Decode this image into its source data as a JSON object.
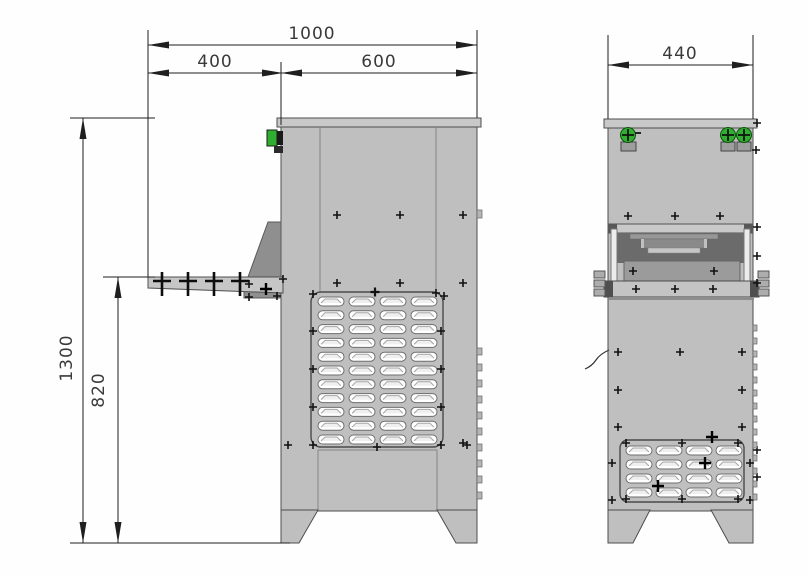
{
  "drawing": {
    "title": "cabinet-two-view-dimension-drawing",
    "unit": "mm",
    "views": [
      "side-elevation",
      "front-elevation"
    ]
  },
  "dims": {
    "total_depth": {
      "value": "1000"
    },
    "shelf_overhang": {
      "value": "400"
    },
    "body_depth": {
      "value": "600"
    },
    "body_width": {
      "value": "440"
    },
    "total_height": {
      "value": "1300"
    },
    "shelf_height": {
      "value": "820"
    }
  },
  "views": {
    "side": {
      "louver_grid": {
        "cols": 4,
        "rows": 11
      }
    },
    "front": {
      "louver_grid": {
        "cols": 4,
        "rows": 4
      }
    }
  },
  "colors": {
    "body": "#bfbfbf",
    "cap": "#c9c9c9",
    "outline": "#4d4d4d",
    "seam": "#858585",
    "recess": "#6b6b6b",
    "bracket": "#8f8f8f",
    "rail": "#ececec",
    "accent_green": "#2fae2f",
    "dim_line": "#1f1f1f",
    "louver_fill": "#ffffff",
    "louver_stroke": "#6e6e6e"
  }
}
